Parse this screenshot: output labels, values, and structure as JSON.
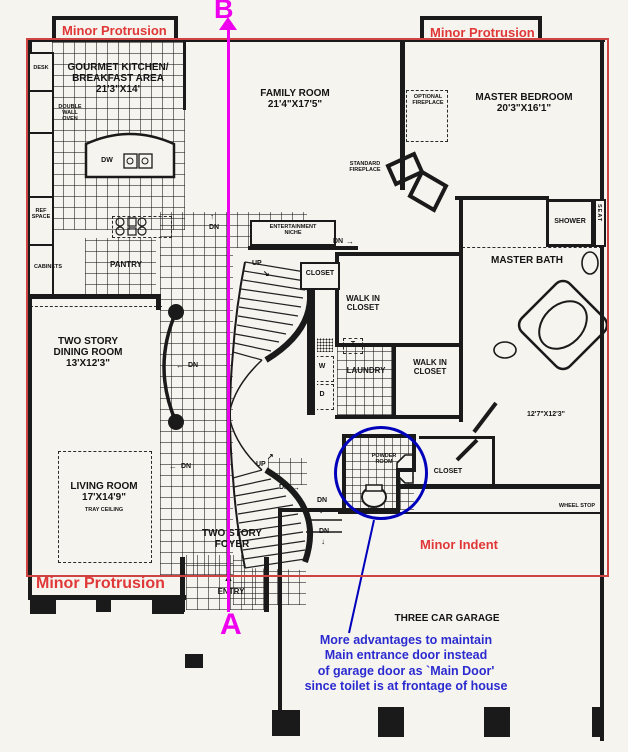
{
  "plan": {
    "rooms": {
      "kitchen": [
        "GOURMET KITCHEN/",
        "BREAKFAST AREA",
        "21'3\"X14'"
      ],
      "family_room": [
        "FAMILY ROOM",
        "21'4\"X17'5\""
      ],
      "master_bedroom": [
        "MASTER BEDROOM",
        "20'3\"X16'1\""
      ],
      "dining_room": [
        "TWO STORY",
        "DINING ROOM",
        "13'X12'3\""
      ],
      "living_room": [
        "LIVING ROOM",
        "17'X14'9\""
      ],
      "living_room_note": "TRAY CEILING",
      "foyer": [
        "TWO STORY",
        "FOYER"
      ],
      "bedroom2_dims": "12'7\"X12'3\"",
      "garage": "THREE CAR GARAGE",
      "master_bath": "MASTER BATH",
      "walk_in_closet_a": [
        "WALK IN",
        "CLOSET"
      ],
      "walk_in_closet_b": [
        "WALK IN",
        "CLOSET"
      ],
      "laundry": "LAUNDRY",
      "pantry": "PANTRY",
      "powder_room": [
        "POWDER",
        "ROOM"
      ]
    },
    "features": {
      "optional_fireplace": [
        "OPTIONAL",
        "FIREPLACE"
      ],
      "standard_fireplace": [
        "STANDARD",
        "FIREPLACE"
      ],
      "entertainment_niche": [
        "ENTERTAINMENT",
        "NICHE"
      ],
      "desk": "DESK",
      "double_wall_oven": [
        "DOUBLE",
        "WALL",
        "OVEN"
      ],
      "ref_space": [
        "REF",
        "SPACE"
      ],
      "cabinets": "CABINETS",
      "dishwasher": "DW",
      "washer": "W",
      "dryer": "D",
      "tub": "T",
      "shower": "SHOWER",
      "seat": "SEAT",
      "closet_hall": "CLOSET",
      "closet_bedroom": "CLOSET",
      "wheel_stop": "WHEEL STOP",
      "entry": "ENTRY",
      "up": "UP",
      "dn": "DN"
    },
    "icons": {
      "arrow_up": "↑",
      "arrow_down": "↓",
      "arrow_left": "←",
      "arrow_right": "→",
      "arrow_up_right": "↗",
      "arrow_down_right": "↘",
      "entry_arrow": "▲"
    }
  },
  "overlay": {
    "section_label_top": "B",
    "section_label_bottom": "A",
    "protrusion_top_left": "Minor Protrusion",
    "protrusion_top_right": "Minor Protrusion",
    "protrusion_bottom_left": "Minor Protrusion",
    "minor_indent": "Minor Indent",
    "note": [
      "More advantages to maintain",
      "Main entrance door instead",
      "of garage door as `Main Door'",
      "since toilet is at frontage of house"
    ],
    "colors": {
      "outline_red": "#d04343",
      "label_red": "#e03838",
      "section_magenta": "#ee00ee",
      "note_blue": "#2b2bd0",
      "circle_blue": "#0000bb",
      "plan_black": "#1a1a1a",
      "paper": "#f6f4ef"
    }
  }
}
